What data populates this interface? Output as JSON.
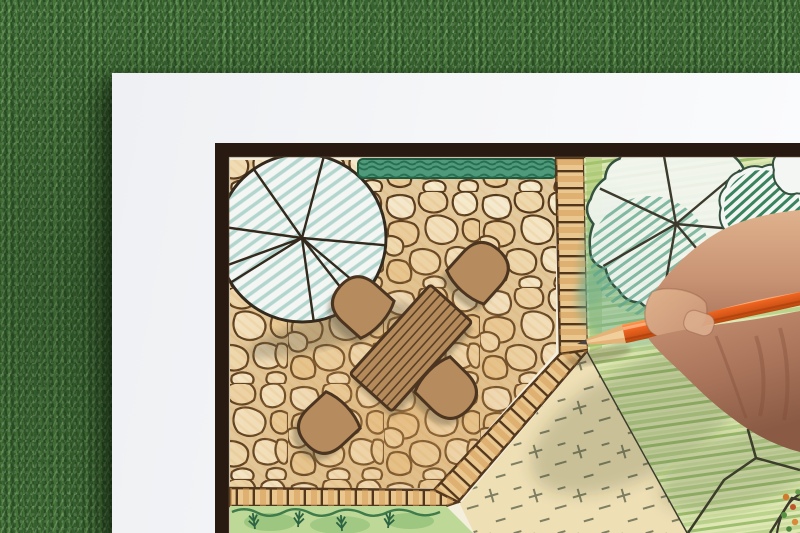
{
  "scene": {
    "type": "photograph",
    "description": "Close-up photo of a hand holding an orange colored pencil while drawing a landscape architecture garden plan on white paper that lies on green grass.",
    "objects": [
      "grass-background",
      "paper-sheet",
      "plan-frame-border",
      "flagstone-patio",
      "shade-tree-symbol-left",
      "hedge-strip",
      "dining-table-symbol",
      "chair-symbol-x4",
      "paver-tile-path",
      "planting-bed",
      "groundcover-area",
      "lawn-area",
      "shade-tree-symbol-right",
      "hatched-shrub",
      "rock-outlines",
      "flower-bed-corner",
      "orange-pencil",
      "drawing-hand"
    ]
  },
  "palette": {
    "grass": "#47763b",
    "paper": "#f5f6f8",
    "frame": "#281a10",
    "drawing_background": "#f4eedd",
    "stone_grout": "#e2cba0",
    "stone_ink": "#53371c",
    "stone_warm_tint": "#dca55e",
    "hedge_green": "#4f9a7a",
    "hedge_dark": "#1f5a40",
    "tile_fill": "#e9c78f",
    "tile_hatch": "#d49a54",
    "bed_green": "#bed898",
    "fern_green": "#2c6342",
    "groundcover_tan": "#eedfb5",
    "groundcover_mark": "#73755a",
    "lawn_base": "#dfe8b4",
    "lawn_stroke": "#93b863",
    "tree_paper": "#f3f6f2",
    "tree_hatch_teal": "#a7cfc8",
    "tree_hatch_deep": "#5ea58c",
    "tree_outline": "#34523f",
    "shrub_hatch": "#2f7d56",
    "table_wood": "#b48a5a",
    "chair_wood": "#b68c5e",
    "outline_dark": "#3c3a2c",
    "pencil_orange": "#ef6420",
    "pencil_highlight": "#ff9b55",
    "pencil_wood": "#e5b377",
    "pencil_lead": "#4a463f",
    "skin_highlight": "#e0b28d",
    "skin_mid": "#c79273",
    "skin_shadow": "#a9745a"
  }
}
